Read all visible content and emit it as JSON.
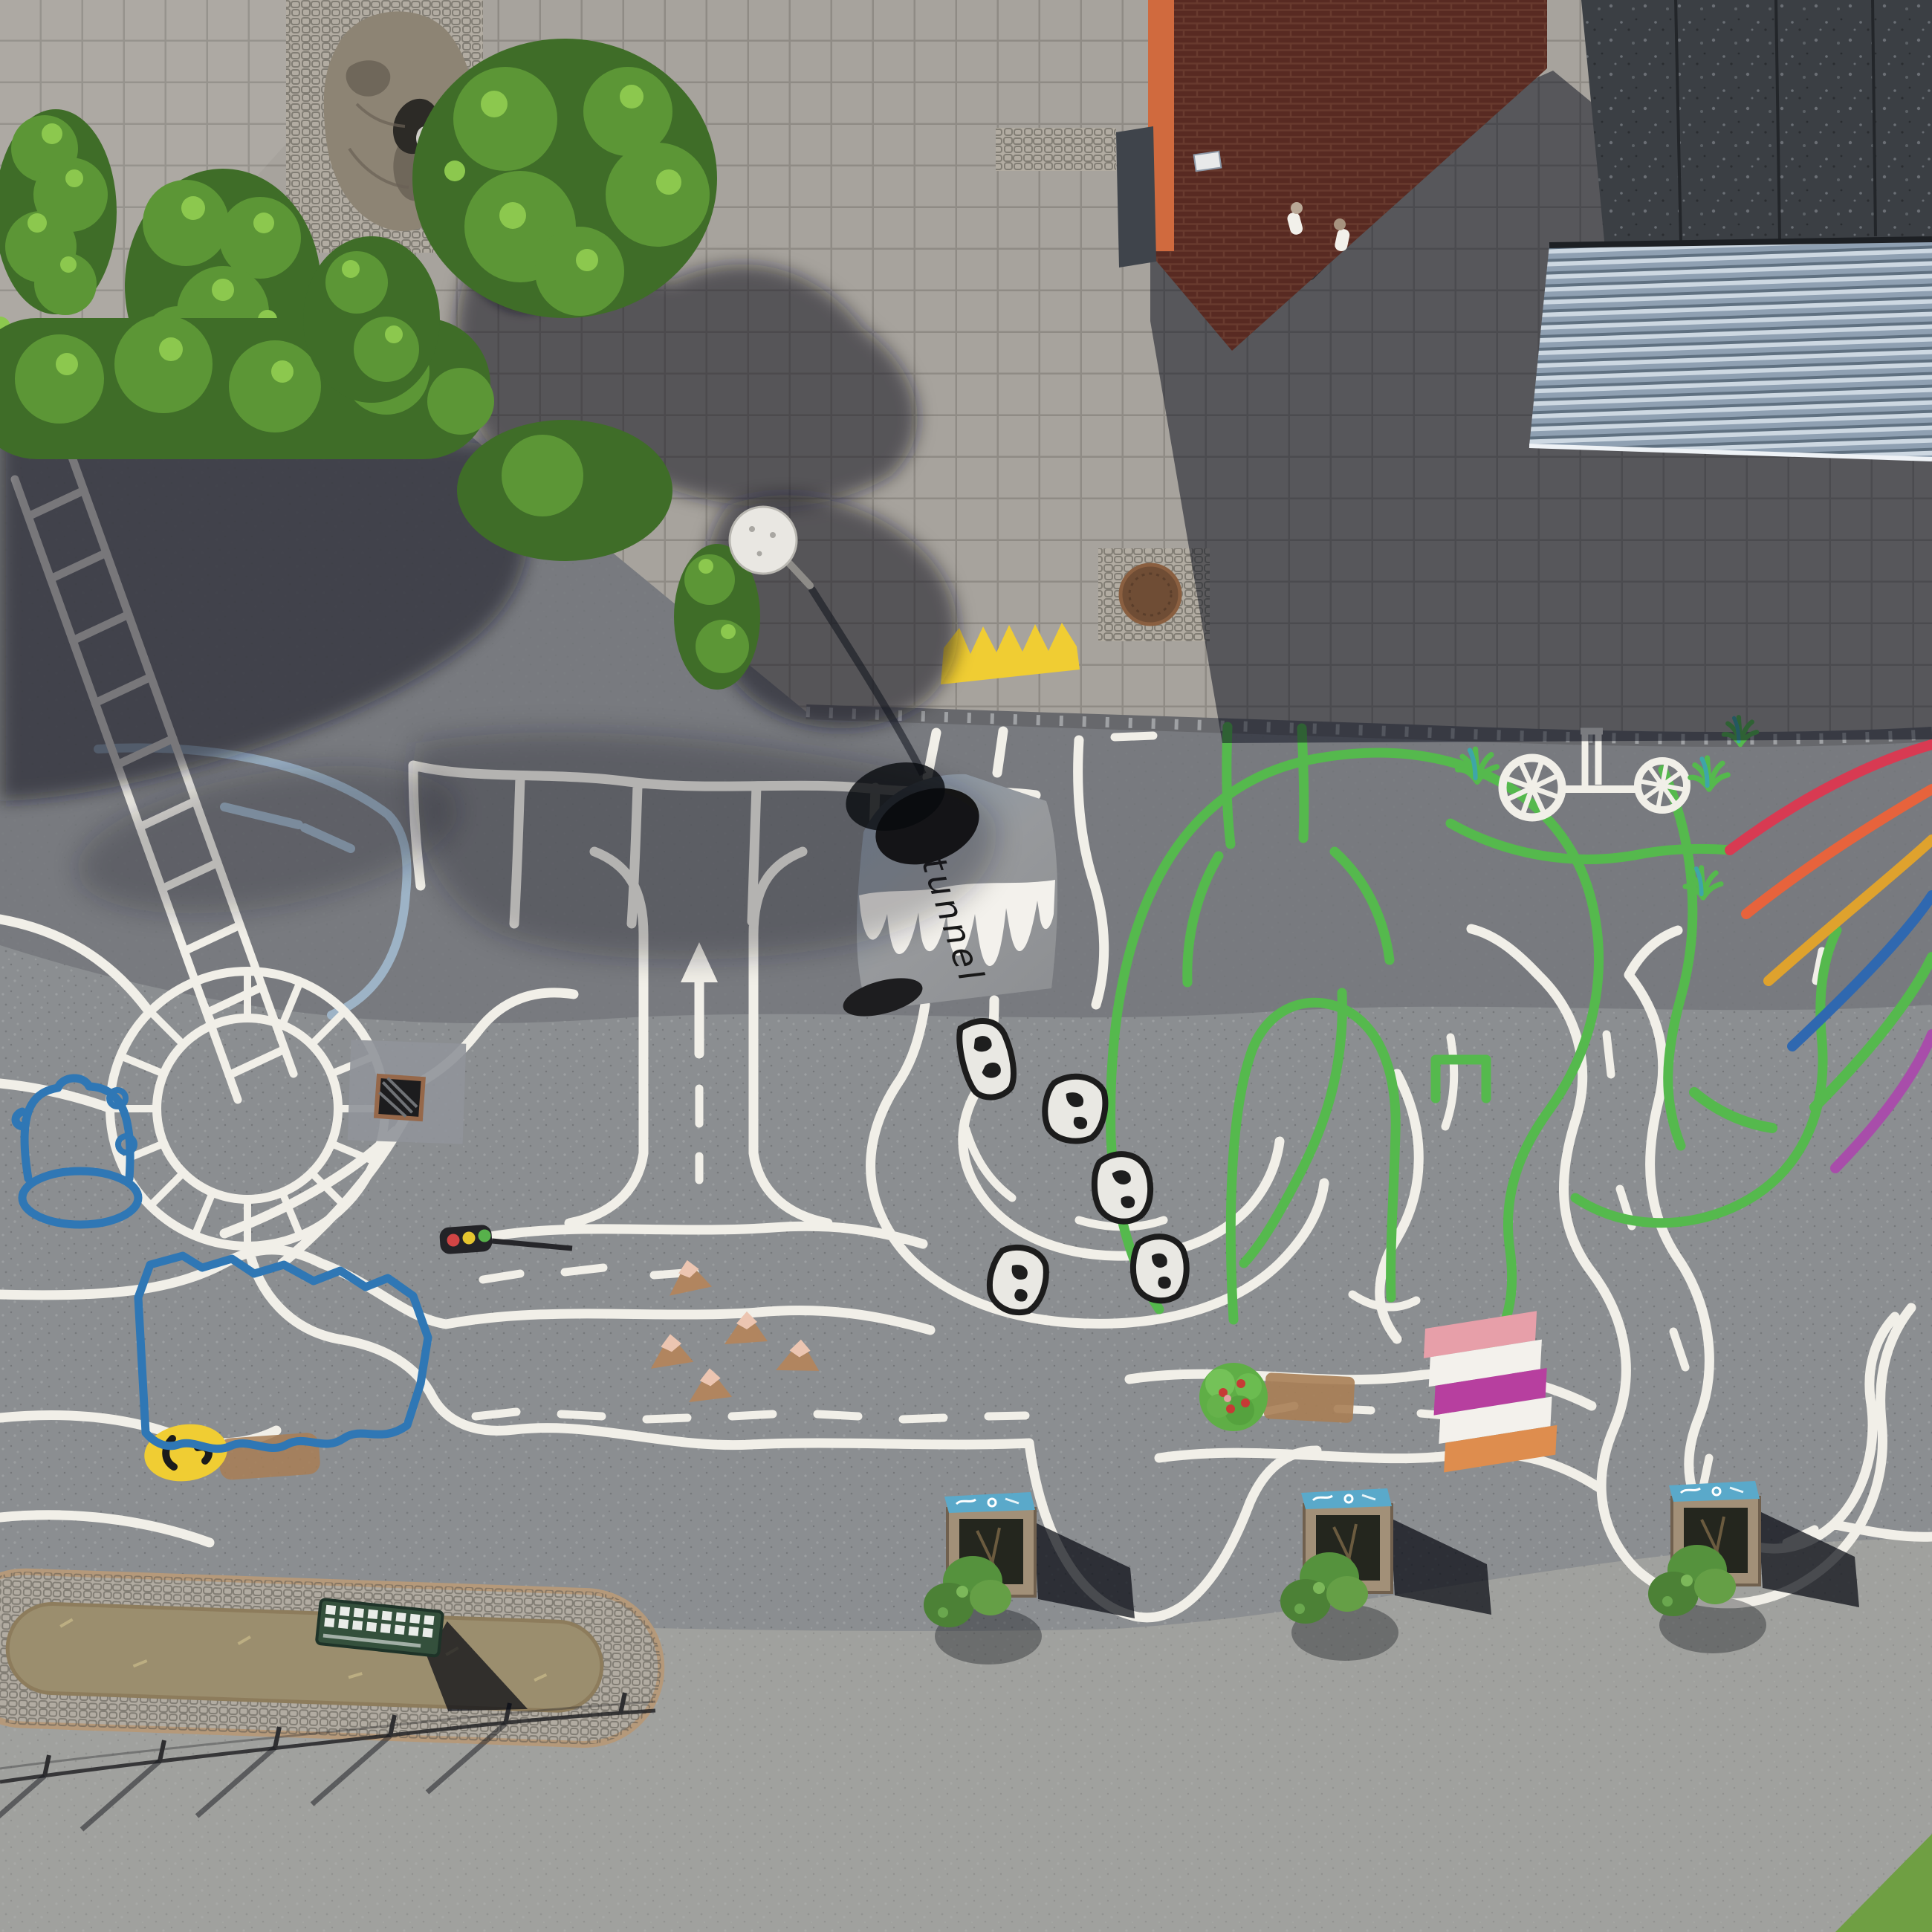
{
  "scene": {
    "type": "aerial drone photograph",
    "setting": "schoolyard traffic playground with painted play roads, seen straight from above",
    "tunnel_label": "tunnel",
    "counts": {
      "planter_boxes": 3,
      "painted_rocks": 5,
      "painted_mountains": 5,
      "rainbow_stripes": 6,
      "crown_points": 5,
      "people": 2
    },
    "painted_elements": [
      "ladder",
      "roundabout",
      "parking-bays",
      "direction-arrow",
      "tunnel",
      "green-maze",
      "bicycle",
      "rainbow",
      "crown",
      "lake",
      "traffic-light",
      "apple-tree",
      "colored-crosswalk",
      "rocks",
      "mountain-cones",
      "grass-tufts",
      "smiley-blob"
    ],
    "rainbow_stripe_colors": [
      "red",
      "orange",
      "amber",
      "blue",
      "green",
      "purple"
    ]
  },
  "colors": {
    "plaza_tile": "#a7a39d",
    "plaza_grout": "#86837d",
    "plaza_light": "#b5b1ab",
    "asphalt_dark": "#74777b",
    "asphalt_mid": "#8b8e91",
    "road_bottom": "#a0a19e",
    "curb_dark": "#67686c",
    "paint_white": "#f1efe8",
    "paint_white_shadow": "#9db3c6",
    "paint_green": "#55b94d",
    "paint_blue": "#2f77b5",
    "paint_yellow": "#f0cd33",
    "paint_black": "#1c1c1c",
    "tunnel_gray": "#97999c",
    "tunnel_gray_shade": "#8798ab",
    "rock_fill": "#e9e8e3",
    "cone_tan": "#b1855f",
    "cone_cap": "#ecc5b1",
    "tree_green": "#5fae46",
    "apple_red": "#c63a35",
    "dirt_brown": "#a87e55",
    "cw_pink": "#e79fa9",
    "cw_magenta": "#b73f9f",
    "cw_orange": "#de8d4e",
    "cw_white": "#f3f1ec",
    "rb_red": "#d83a52",
    "rb_orange": "#e7633c",
    "rb_amber": "#dfa22d",
    "rb_blue": "#2f68b0",
    "rb_green": "#55b94d",
    "rb_purple": "#a84daa",
    "brick_dark": "#582a22",
    "brick_line": "#6f4034",
    "brick_lit": "#d06a3e",
    "roof_dark": "#3b3f44",
    "slat_light": "#cdd8e2",
    "slat_mid": "#8fa0b2",
    "slat_dark": "#5f7080",
    "hedge_dark": "#3f6d28",
    "hedge_mid": "#5c9636",
    "hedge_light": "#8cc84e",
    "shadow_cast": "rgba(13,18,31,0.55)",
    "shadow_deep": "rgba(8,11,20,0.72)",
    "boulder": "#8d8474",
    "boulder_dark": "#6a6156",
    "cobble": "#b2aca2",
    "curb_tan": "#b5997a",
    "strip_dirt": "#9b8e6e",
    "planter_wood": "#a29078",
    "planter_blue": "#5aa9ca",
    "plant_green": "#55923d",
    "bench_green": "#34503c",
    "lamp_disc": "#e9e7e2",
    "grass_corner": "#6f9f43",
    "drain_rust": "#96684a",
    "people_white": "#f2f0ea"
  }
}
